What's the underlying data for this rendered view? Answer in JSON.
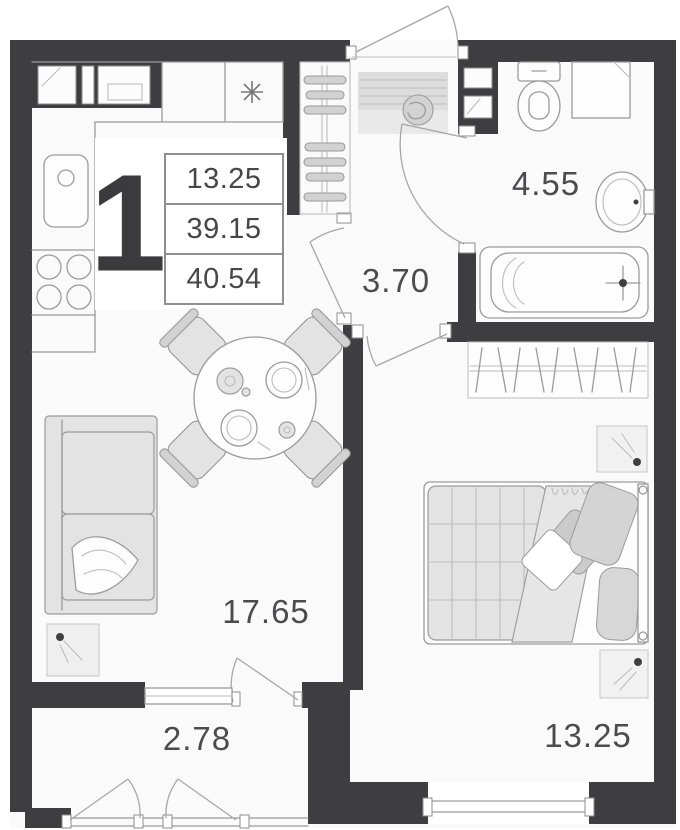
{
  "apartment": {
    "number": "1",
    "area_rows": [
      "13.25",
      "39.15",
      "40.54"
    ]
  },
  "rooms": {
    "bathroom": "4.55",
    "hallway": "3.70",
    "living_kitchen": "17.65",
    "balcony": "2.78",
    "bedroom": "13.25"
  },
  "icons": {
    "light_symbol": "asterisk"
  },
  "colors": {
    "wall": "#3e3e41",
    "floor": "#fafafa",
    "furniture_line": "#9b9b9b",
    "furniture_fill": "#e3e3e3",
    "label_text": "#4c4c4e",
    "table_border": "#8f8f8f"
  }
}
